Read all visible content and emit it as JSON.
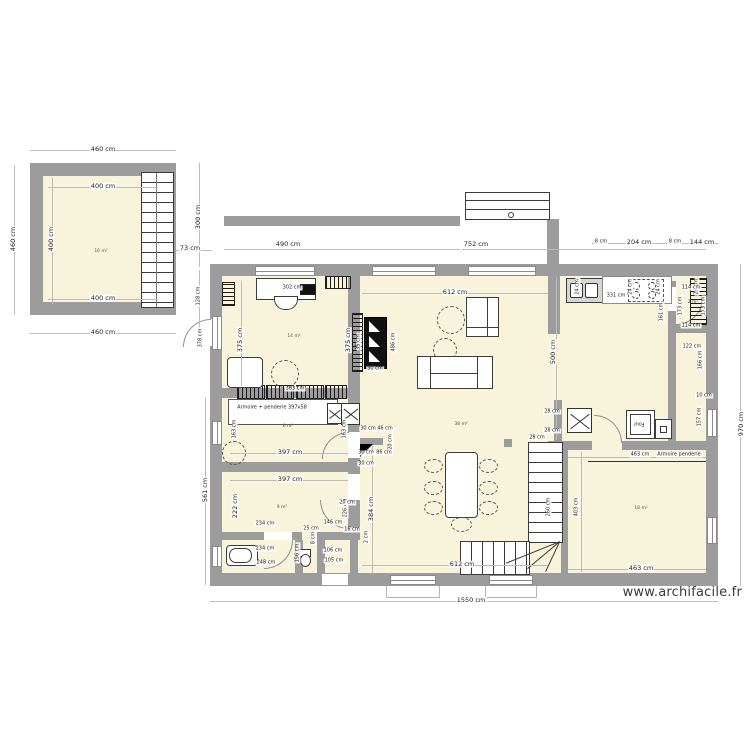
{
  "watermark": "www.archifacile.fr",
  "colors": {
    "wall": "#9c9c9c",
    "floor": "#f8f4dc",
    "dim_text": "#1c1c1c",
    "dim_line": "#bcbcbc"
  },
  "plan": {
    "title": "House ground floor plan",
    "units": "cm",
    "labels": [
      {
        "t": "460 cm",
        "x": 103,
        "y": 149
      },
      {
        "t": "400 cm",
        "x": 103,
        "y": 186
      },
      {
        "t": "460 cm",
        "x": 13,
        "y": 239,
        "r": "v"
      },
      {
        "t": "400 cm",
        "x": 51,
        "y": 239,
        "r": "v"
      },
      {
        "t": "400 cm",
        "x": 103,
        "y": 298
      },
      {
        "t": "460 cm",
        "x": 103,
        "y": 332
      },
      {
        "t": "16 m²",
        "x": 101,
        "y": 252,
        "s": 2
      },
      {
        "t": "300 cm",
        "x": 198,
        "y": 217,
        "r": "v"
      },
      {
        "t": "73 cm",
        "x": 190,
        "y": 248
      },
      {
        "t": "128 cm",
        "x": 199,
        "y": 296,
        "r": "v",
        "s": 1
      },
      {
        "t": "378 cm",
        "x": 201,
        "y": 338,
        "r": "v",
        "s": 1
      },
      {
        "t": "490 cm",
        "x": 288,
        "y": 244
      },
      {
        "t": "752 cm",
        "x": 476,
        "y": 244
      },
      {
        "t": "8 cm",
        "x": 601,
        "y": 242,
        "s": 1
      },
      {
        "t": "204 cm",
        "x": 639,
        "y": 242
      },
      {
        "t": "8 cm",
        "x": 675,
        "y": 242,
        "s": 1
      },
      {
        "t": "144 cm",
        "x": 702,
        "y": 242
      },
      {
        "t": "24 cm",
        "x": 578,
        "y": 287,
        "r": "v",
        "s": 1
      },
      {
        "t": "24 cm",
        "x": 631,
        "y": 287,
        "r": "v",
        "s": 1
      },
      {
        "t": "24 cm",
        "x": 659,
        "y": 287,
        "r": "v",
        "s": 1
      },
      {
        "t": "24 cm",
        "x": 697,
        "y": 287,
        "r": "v",
        "s": 1
      },
      {
        "t": "331 cm",
        "x": 616,
        "y": 296,
        "s": 1
      },
      {
        "t": "161 cm",
        "x": 662,
        "y": 312,
        "r": "v",
        "s": 1
      },
      {
        "t": "114 cm",
        "x": 691,
        "y": 288,
        "s": 1
      },
      {
        "t": "173 cm",
        "x": 681,
        "y": 306,
        "r": "v",
        "s": 1
      },
      {
        "t": "173 cm",
        "x": 704,
        "y": 306,
        "r": "v",
        "s": 1
      },
      {
        "t": "2 m²",
        "x": 693,
        "y": 303,
        "s": 2
      },
      {
        "t": "114 cm",
        "x": 691,
        "y": 326,
        "s": 1
      },
      {
        "t": "122 cm",
        "x": 692,
        "y": 347,
        "s": 1
      },
      {
        "t": "166 cm",
        "x": 701,
        "y": 360,
        "r": "v",
        "s": 1
      },
      {
        "t": "10 cm",
        "x": 704,
        "y": 396,
        "s": 1
      },
      {
        "t": "157 cm",
        "x": 700,
        "y": 417,
        "r": "v",
        "s": 1
      },
      {
        "t": "970 cm",
        "x": 741,
        "y": 424,
        "r": "v"
      },
      {
        "t": "612 cm",
        "x": 455,
        "y": 292
      },
      {
        "t": "302 cm",
        "x": 292,
        "y": 288,
        "s": 1
      },
      {
        "t": "375 cm",
        "x": 240,
        "y": 340,
        "r": "v"
      },
      {
        "t": "375 cm",
        "x": 348,
        "y": 340,
        "r": "v"
      },
      {
        "t": "14 m²",
        "x": 294,
        "y": 337,
        "s": 2
      },
      {
        "t": "363 cm",
        "x": 295,
        "y": 389,
        "s": 1
      },
      {
        "t": "35 cm",
        "x": 359,
        "y": 342,
        "r": "v",
        "s": 1
      },
      {
        "t": "486 cm",
        "x": 394,
        "y": 342,
        "r": "v",
        "s": 1
      },
      {
        "t": "30 cm",
        "x": 375,
        "y": 369,
        "s": 1
      },
      {
        "t": "500 cm",
        "x": 553,
        "y": 352,
        "r": "v"
      },
      {
        "t": "38 m²",
        "x": 461,
        "y": 425,
        "s": 2
      },
      {
        "t": "Armoire + penderie 397x58",
        "x": 272,
        "y": 408,
        "s": 1
      },
      {
        "t": "163 cm",
        "x": 235,
        "y": 429,
        "r": "v",
        "s": 1
      },
      {
        "t": "163 cm",
        "x": 345,
        "y": 429,
        "r": "v",
        "s": 1
      },
      {
        "t": "6 m²",
        "x": 288,
        "y": 427,
        "s": 2
      },
      {
        "t": "397 cm",
        "x": 290,
        "y": 452
      },
      {
        "t": "30 cm",
        "x": 368,
        "y": 429,
        "s": 1
      },
      {
        "t": "46 cm",
        "x": 385,
        "y": 429,
        "s": 1
      },
      {
        "t": "20 cm",
        "x": 391,
        "y": 442,
        "r": "v",
        "s": 1
      },
      {
        "t": "30 cm",
        "x": 366,
        "y": 453,
        "s": 1
      },
      {
        "t": "86 cm",
        "x": 384,
        "y": 453,
        "s": 1
      },
      {
        "t": "30 cm",
        "x": 366,
        "y": 464,
        "s": 1
      },
      {
        "t": "28 cm",
        "x": 552,
        "y": 412,
        "s": 1
      },
      {
        "t": "28 cm",
        "x": 552,
        "y": 431,
        "s": 1
      },
      {
        "t": "Four",
        "x": 639,
        "y": 423,
        "r": "u",
        "s": 1
      },
      {
        "t": "463 cm",
        "x": 640,
        "y": 455,
        "s": 1
      },
      {
        "t": "Armoire penderie",
        "x": 679,
        "y": 455,
        "s": 1
      },
      {
        "t": "28 cm",
        "x": 537,
        "y": 438,
        "s": 1
      },
      {
        "t": "260 cm",
        "x": 549,
        "y": 507,
        "r": "v",
        "s": 1
      },
      {
        "t": "403 cm",
        "x": 577,
        "y": 507,
        "r": "v",
        "s": 1
      },
      {
        "t": "397 cm",
        "x": 290,
        "y": 479
      },
      {
        "t": "222 cm",
        "x": 235,
        "y": 506,
        "r": "v"
      },
      {
        "t": "226 cm",
        "x": 346,
        "y": 508,
        "r": "v",
        "s": 1
      },
      {
        "t": "9 m²",
        "x": 282,
        "y": 508,
        "s": 2
      },
      {
        "t": "234 cm",
        "x": 265,
        "y": 524,
        "s": 1
      },
      {
        "t": "146 cm",
        "x": 333,
        "y": 523,
        "s": 1
      },
      {
        "t": "25 cm",
        "x": 311,
        "y": 529,
        "s": 1
      },
      {
        "t": "8 cm",
        "x": 314,
        "y": 538,
        "r": "v",
        "s": 1
      },
      {
        "t": "20 cm",
        "x": 347,
        "y": 503,
        "s": 1
      },
      {
        "t": "16 cm",
        "x": 352,
        "y": 530,
        "s": 1
      },
      {
        "t": "234 cm",
        "x": 265,
        "y": 549,
        "s": 1
      },
      {
        "t": "248 cm",
        "x": 266,
        "y": 563,
        "s": 1
      },
      {
        "t": "156 cm",
        "x": 298,
        "y": 553,
        "r": "v",
        "s": 1
      },
      {
        "t": "106 cm",
        "x": 333,
        "y": 551,
        "s": 1
      },
      {
        "t": "105 cm",
        "x": 334,
        "y": 561,
        "s": 1
      },
      {
        "t": "2 cm",
        "x": 367,
        "y": 537,
        "r": "v",
        "s": 1
      },
      {
        "t": "384 cm",
        "x": 371,
        "y": 509,
        "r": "v"
      },
      {
        "t": "612 cm",
        "x": 462,
        "y": 564
      },
      {
        "t": "463 cm",
        "x": 641,
        "y": 568
      },
      {
        "t": "18 m²",
        "x": 641,
        "y": 509,
        "s": 2
      },
      {
        "t": "1550 cm",
        "x": 471,
        "y": 600
      },
      {
        "t": "561 cm",
        "x": 205,
        "y": 490,
        "r": "v"
      }
    ]
  }
}
